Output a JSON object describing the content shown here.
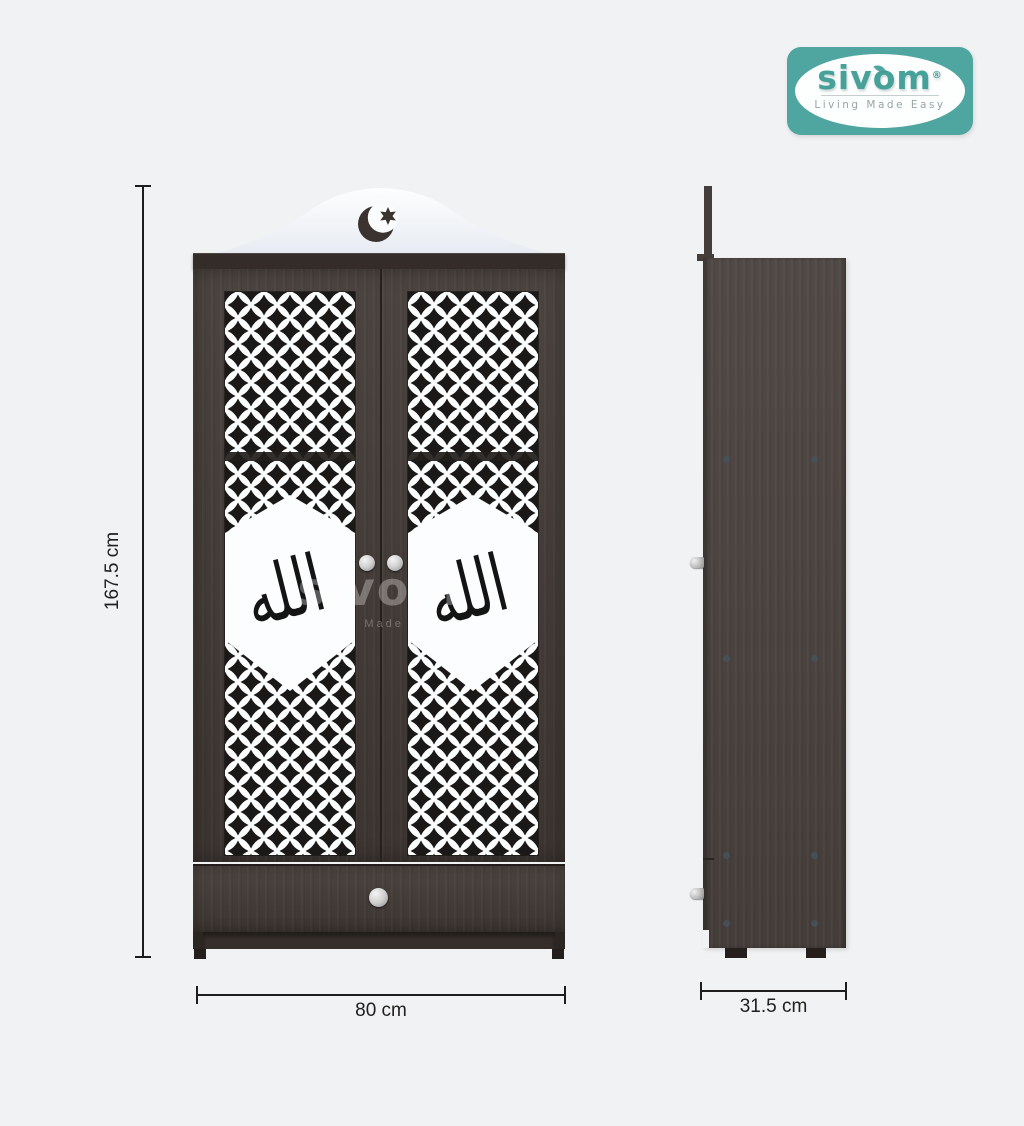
{
  "brand": {
    "name": "sivom",
    "registered_mark": "®",
    "tagline": "Living Made Easy",
    "teal": "#4fa5a0"
  },
  "watermark": {
    "name": "sivom",
    "tagline": "Living Made Easy"
  },
  "product": {
    "type": "two-door wardrobe with islamic jali pattern, crescent crest and bottom drawer",
    "calligraphy": "الله"
  },
  "dimensions": {
    "height": "167.5 cm",
    "width": "80 cm",
    "depth": "31.5 cm"
  },
  "colors": {
    "background": "#f1f2f3",
    "wood_front": "#423a36",
    "wood_side": "#4a423e",
    "panel_white": "#fcfdfe",
    "pattern_black": "#1b1918",
    "dimension_line": "#1d1d1d",
    "logo_teal": "#4fa5a0"
  }
}
